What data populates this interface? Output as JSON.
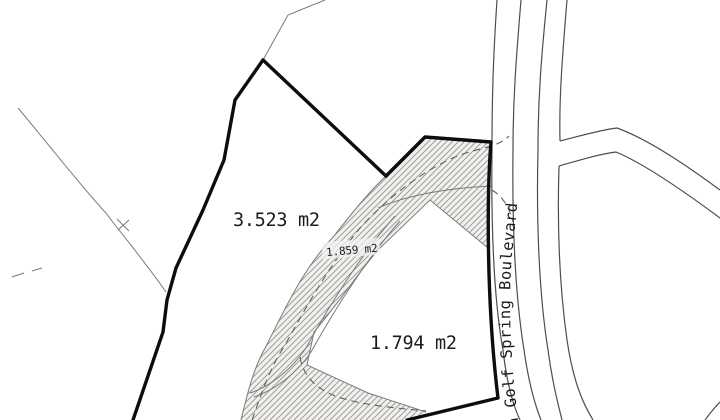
{
  "plan": {
    "parcels": [
      {
        "name": "large-parcel",
        "area": "3.523 m2"
      },
      {
        "name": "driveway-parcel",
        "area": "1.859 m2"
      },
      {
        "name": "small-parcel",
        "area": "1.794 m2"
      }
    ],
    "road_name": "n Golf Spring Boulevard",
    "colors": {
      "background": "#ffffff",
      "boundary": "#0d0d0d",
      "road_line": "#4d4d4d",
      "thin_line": "#7a7a7a",
      "dashed_line": "#5f5f5f",
      "hatch_line": "#98958f",
      "hatch_fill": "#f1f0ee",
      "label_text": "#1c1c1c"
    }
  }
}
